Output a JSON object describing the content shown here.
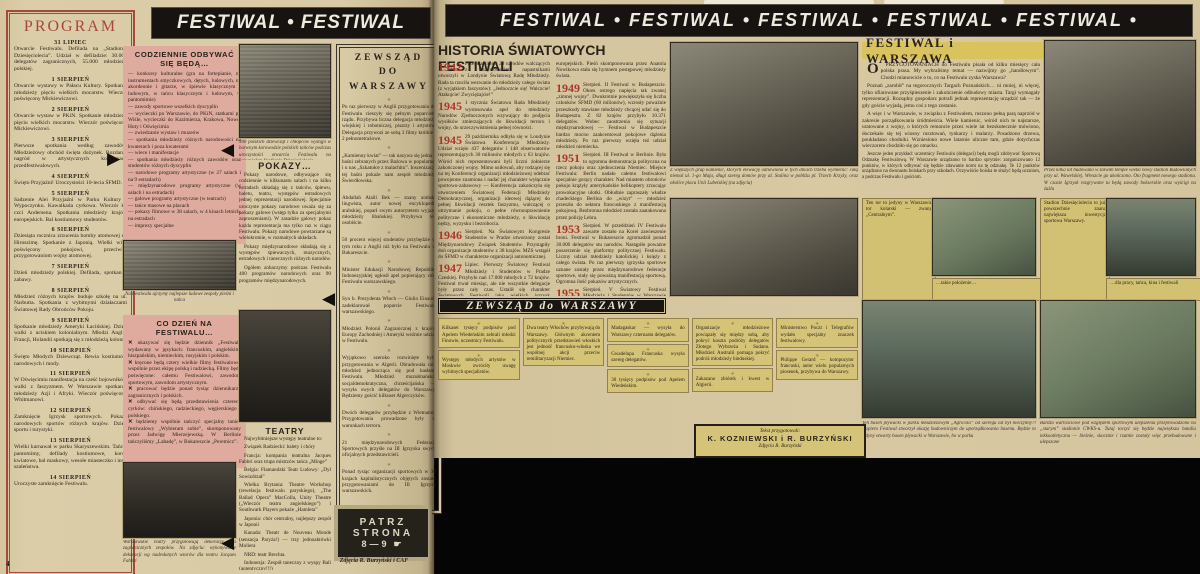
{
  "palette": {
    "newsprint": "#d8caa4",
    "pink_box": "#dfab9e",
    "yellow_box": "#d3c173",
    "accent_red": "#a8473c",
    "banner_black": "#171310",
    "ink": "#2a231b"
  },
  "left_page": {
    "page_number": "4",
    "banner": "FESTIWAL • FESTIWAL",
    "program": {
      "title": "PROGRAM",
      "entries": [
        {
          "date": "31 LIPIEC",
          "text": "Otwarcie Festiwalu. Defilada na „Stadionie Dziesięciolecia”. Udział w defiladzie: 30.000 delegatów zagranicznych, 55.000 młodzieży polskiej."
        },
        {
          "date": "1 SIERPIEŃ",
          "text": "Otwarcie wystawy w Pałacu Kultury. Spotkanie młodzieży pięciu wielkich mocarstw. Wieczór poświęcony Mickiewiczowi."
        },
        {
          "date": "2 SIERPIEŃ",
          "text": "Otwarcie wystaw w PKiN. Spotkanie młodzieży pięciu wielkich mocarstw. Wieczór poświęcony Mickiewiczowi."
        },
        {
          "date": "3 SIERPIEŃ",
          "text": "Pierwsze spotkania według zawodów. Młodzieżowy obchód święta dożynek. Rozdanie nagród w artystycznych konkursach przedfestiwalowych."
        },
        {
          "date": "4 SIERPIEŃ",
          "text": "Święto Przyjaźni! Uroczystości 10-lecia ŚFMD."
        },
        {
          "date": "5 SIERPIEŃ",
          "text": "Sadzenie Alei Przyjaźni w Parku Kultury i Wypoczynku. Kawalkada cyrkowa. Wieczór ku czci Andersena. Spotkania młodzieży krajów europejskich. Bal kostiumowy studentów."
        },
        {
          "date": "6 SIERPIEŃ",
          "text": "Dziesiąta rocznica zrzucenia bomby atomowej na Hiroszimę. Spotkanie z Japonią. Wielki wiec poświęcony pokojowi, przeciwko przygotowaniom wojny atomowej."
        },
        {
          "date": "7 SIERPIEŃ",
          "text": "Dzień młodzieży polskiej. Defilada, spotkania, zabawy."
        },
        {
          "date": "8 SIERPIEŃ",
          "text": "Młodzież różnych krajów buduje szkołę na ul. Narbutta. Spotkania z wybitnymi działaczami Światowej Rady Obrońców Pokoju."
        },
        {
          "date": "9 SIERPIEŃ",
          "text": "Spotkanie młodzieży Ameryki Łacińskiej. Dzień walki z uciskiem kolonialnym. Młodzi Anglii, Francji, Holandii spotkają się z młodzieżą kolonii."
        },
        {
          "date": "10 SIERPIEŃ",
          "text": "Święto Młodych Dziewcząt. Rewia kostiumów narodowych i mody."
        },
        {
          "date": "11 SIERPIEŃ",
          "text": "W Oświęcimiu manifestacja na cześć bojowników walki z faszyzmem. W Warszawie spotkania młodzieży Azji i Afryki. Wieczór poświęcony Whitmanowi."
        },
        {
          "date": "12 SIERPIEŃ",
          "text": "Zamknięcie Igrzysk sportowych. Pokazy narodowych sportów różnych krajów. Dzień sportu i turystyki."
        },
        {
          "date": "13 SIERPIEŃ",
          "text": "Wielki karnawał w parku Skaryszewskim. Tańce, pantomimy, defilady kostiumowe, korso kwiatowe, bal maskowy, wesołe miasteczko i inne szaleństwa."
        },
        {
          "date": "14 SIERPIEŃ",
          "text": "Uroczyste zamknięcie Festiwalu."
        }
      ]
    },
    "daily": {
      "title": "CODZIENNIE ODBYWAĆ SIĘ BĘDĄ…",
      "items": [
        "— konkursy kulturalne (gra na fortepianie, na instrumentach smyczkowych, dętych, ludowych, na akordeonie i gitarze, w śpiewie klasycznym i ludowym, w tańcu klasycznym i ludowym, w pantomimie)",
        "— zawody sportowe wszelkich dyscyplin",
        "— wycieczki po Warszawie, do PKiN, statkami po Wiśle, wycieczki do Kazimierza, Krakowa, Nowej Huty i Oświęcimia",
        "— zwiedzanie wystaw i muzeów",
        "— spotkania młodzieży różnych narodowości na kwaterach i poza kwaterami",
        "— wiece i manifestacje",
        "— spotkania młodzieży różnych zawodów oraz studentów różnych dyscyplin",
        "— narodowe programy artystyczne (w 27 salach i na 9 estradach)",
        "— międzynarodowe programy artystyczne (w salach i na estradach)",
        "— galowe programy artystyczne (w teatrach)",
        "— tańce masowe na placach",
        "— pokazy filmowe w 38 salach, w 4 kinach letnich, na estradach",
        "— imprezy specjalne"
      ]
    },
    "parade_caption": "Na Festiwalu ujrzymy najlepsze ludowe zespoły pieśni i tańca",
    "pokazy": {
      "caption_above": "500 polskich dziewcząt i chłopców wystąpi w barwnym korowodzie polskich tańców podczas uroczystości otwarcia Festiwalu na wspaniałym Stadionie Dziesięciolecia",
      "title": "POKAZY…",
      "paragraphs": [
        "Pokazy narodowe, odbywające się codziennie w kilkunastu salach i na kilku estradach składają się z tańców, śpiewu, baletu, teatru, występów estradowych jednej reprezentacji narodowej. Specjalnie uroczyste pokazy narodowe uważa się za pokazy galowe (wstęp tylko za specjalnymi zaproszeniami). W zasadzie galowy pokaz każda reprezentacja ma tylko raz w ciągu Festiwalu. Pokazy narodowe powtarzane są wielokrotnie, w rozmaitych układach.",
        "Pokazy międzynarodowe składają się z występów śpiewaczych, muzycznych, estradowych i tanecznych różnych narodów.",
        "Ogółem zobaczymy podczas Festiwalu 400 programów narodowych oraz 90 programów międzynarodowych."
      ]
    },
    "codzien": {
      "title": "CO DZIEŃ NA FESTIWALU…",
      "items": [
        "ukazywać się będzie dziennik „Festiwal” wydawany w językach: francuskim, angielskim, hiszpańskim, niemieckim, rosyjskim i polskim.",
        "kręcone będą cztery wielkie filmy festiwalowe, wspólnie przez ekipę polską i radziecką. Filmy będą poświęcone: całemu Festiwalowi, zawodom sportowym, zawodom artystycznym.",
        "pracować będzie ponad tysiąc dziennikarzy zagranicznych i polskich.",
        "odbywać się będą przedstawienia czterech cyrków: chińskiego, radzieckiego, węgierskiego i polskiego.",
        "będziemy wspólnie tańczyć specjalny taniec festiwalowy „Wybieram sobie”, skomponowany przez Jadwigę Mierzejewską. W Berlinie tańczyliśmy „Labadę”, w Bukareszcie „Peremicz”."
      ]
    },
    "decor_caption": "Warszawskie teatry przygotowują dekoracje dla zagranicznych zespołów. Na zdjęciu: wykonywanie dekoracji wg nadesłanych wzorów dla teatru Jacques Fabbri",
    "teatry": {
      "title": "TEATRY",
      "intro": "Najwybitniejsze występy teatralne to:",
      "items": [
        "Związek Radziecki: balety i chóry",
        "Francja: kompania teatralna Jacques Fabbri oraz trupa mistrzów tańca „Minge”",
        "Belgia: Flamandzki Teatr Ludowy: „Dyl Sowizdrzał”",
        "Wielka Brytania: Theatre Workshop (rewelacja festiwalu paryskiego), „The Ballad Opera” MacColla, Unity Theatre („Wieczór teatru angielskiego”) i Southwark Players pokaże „Hamleta”",
        "Japonia: chór centralny, najlepszy zespół w Japonii",
        "Kanada: Theatr de Nouveau Monde (sensacja Paryża!) — trzy jednoaktówki Moliera",
        "NRD: teatr Brechta.",
        "Indonezja: Zespół taneczny z wyspy Bali (autentyczny!!!)"
      ]
    },
    "zewszad": {
      "title_lines": [
        "ZEWSZĄD",
        "DO",
        "WARSZAWY"
      ],
      "items": [
        "Po raz pierwszy w Anglii przygotowania do Festiwalu cieszyły się pełnym poparciem rządu. Przybywa liczna delegacja młodzieży wiejskiej i robotniczej, pisarzy i artystów. Delegacja przywozi ze sobą 3 filmy krótkie i 2 pełnometrażowe.",
        "„Kamienny kwiat” — tak nazywa się jedna z baśni zebranych przez Bażowa w popularnej i u nas „Szkatułce z malachitu”. Inscenizację tej baśni pokaże nam zespół młodzieży Świerdłowska.",
        "Abdallah Alaili Bek — znany arabski lingwista, autor nowej encyklopedii arabskiej, poparł swym autorytetem wyjazd młodzieży libańskiej. Przybywa też osobiście.",
        "50 procent więcej studentów przybędzie w tym roku z Anglii niż było na Festiwalu w Bukareszcie.",
        "Minister Edukacji Narodowej Republiki Indonezyjskiej ogłosił apel popierający cele Festiwalu warszawskiego.",
        "Syn b. Prezydenta Włoch — Giulio Einaudi zadeklarował poparcie Festiwalu warszawskiego.",
        "Młodzież Polonii Zagranicznej z krajów Europy Zachodniej i Ameryki weźmie udział w Festiwalu.",
        "Wyjątkowo szeroko rozwinięte były przygotowania w Algerii. Obradowała cała młodzież jednocząca się pod hasłami Festiwalu. Młodzież muzułmańska, socjaldemokratyczna, chrześcijańska — wysyła swych delegatów do Warszawy. Będziemy gościć kilkuset Algerczyków.",
        "Dwóch delegatów przybędzie z Wietnamu. Przygotowania prowadzone były w warunkach terroru.",
        "21 międzynarodowych Federacji Sportowych przyśle na III Igrzyska swych oficjalnych przedstawicieli.",
        "Ponad tysiąc organizacji sportowych w 30 krajach kapitalistycznych objętych zostało przygotowaniami do III Igrzysk warszawskich."
      ]
    },
    "patrz": {
      "l1": "PATRZ",
      "l2": "STRONA",
      "l3": "8—9",
      "hand": "☛"
    },
    "credit": "Zdjęcia R. Burzyński i CAF"
  },
  "right_page": {
    "banner": "FESTIWAL • FESTIWAL • FESTIWAL • FESTIWAL • FESTIWAL •",
    "history": {
      "title": "HISTORIA ŚWIATOWYCH FESTIWALI",
      "col1": [
        {
          "year": "1942",
          "text": "Przedstawiciele 29 narodów walczących z faszystowskimi napastnikami utworzyli w Londynie Światową Radę Młodzieży. Rada ta rzuciła wezwanie do młodzieży całego świata (z wyjątkiem faszystów): „Jednoczcie się! Walczcie! Atakujcie! Zwyciężajcie!”"
        },
        {
          "year": "1945",
          "text": "1 stycznia Światowa Rada Młodzieży wystosowała apel do młodzieży Narodów Zjednoczonych wzywający do podjęcia wysiłków zmierzających do likwidacji terroru i wojny, do urzeczywistnienia pełnej równości."
        },
        {
          "year": "1945",
          "text": "29 października odbyła się w Londynie Światowa Konferencja Młodzieży. Udział wzięło 437 delegatów i 148 obserwatorów reprezentujących 30 milionów młodych z 63 krajów. Wśród nich reprezentowani byli liczni żołnierze zakończonej wojny. Mimo usiłowań, aby rodzącej się na tej Konferencji organizacji młodzieżowej odebrać powojenne znamiona i nadać jej charakter wyłącznie sportowo-zabawowy — Konferencja zakończyła się utworzeniem Światowej Federacji Młodzieży Demokratycznej, organizacji ideowej dążącej do pełnej likwidacji resztek faszyzmu, walczącej o utrzymanie pokoju, o pełne równouprawnienie polityczne i ekonomiczne młodzieży, o likwidację nędzy, wyzysku i bezrobocia."
        },
        {
          "year": "1946",
          "text": "Sierpień. Na Światowym Kongresie Studentów w Pradze utworzony został Międzynarodowy Związek Studentów. Przystąpiły doń organizacje studentów z 38 krajów. MZS wstąpił do ŚFMD w charakterze organizacji autonomicznej."
        },
        {
          "year": "1947",
          "text": "Lipiec. Pierwszy Światowy Festiwal Młodzieży i Studentów w Pradze Czeskiej. Przybyło nań 17.000 młodych z 72 krajów. Festiwal trwał miesiąc, ale nie wszystkie delegacje były przez cały czas. Ustalił się charakter Światowych Festiwali jako wielkich igrzysk kulturalnych oraz spotkań międzynarodowych. Młodzież wzięła udział w pracach nad odbudową Lidic. Lidice były punktem, do którego dotarły sztafety z wszystkich krajów"
        }
      ],
      "col2_intro": "europejskich. Pieśń skomponowana przez Anatola Nowikowa stała się hymnem postępowej młodzieży świata.",
      "col2": [
        {
          "year": "1949",
          "text": "Sierpień. II Festiwal w Budapeszcie. Okres ostrego napięcia tak zwanej „zimnej wojny”. Dwukrotnie powiększyła się liczba członków ŚFMD (60 milionów), wzrosły poważnie przeszkody stawiane młodzieży chcącej udać się do Budapesztu. Z 82 krajów przybyło 10.371 delegatów. Wobec zaostrzenia się sytuacji międzynarodowej — Festiwal w Budapeszcie bardzo mocno zaakcentował pokojowe dążenia młodzieży. Po raz pierwszy wzięła też udział młodzież niemiecka."
        },
        {
          "year": "1951",
          "text": "Sierpień. III Festiwal w Berlinie. Była to ogromna demonstracja polityczna na rzecz pokoju oraz zjednoczenia Niemiec. Miejsce Festiwalu: Berlin nadało całemu festiwalowi specjalnie gorący charakter. Nad miastem obrońców pokoju krążyły amerykańskie helikoptery zrzucając prowokacyjne ulotki. Obłudnie zapraszały władze chadeckiego Berlina do „wizyt” — młodzież przeszła do sektora francuskiego z manifestacją pokojową. Bezbronna młodzież została zaatakowana przez policję Lehra."
        },
        {
          "year": "1953",
          "text": "Sierpień. W przeddzień IV Festiwalu zawarte zostało na Korei zawieszenie broni. Festiwal w Bukareszcie zgromadził ponad 30.000 delegatów stu narodów. Nastąpiło poważne poszerzenie się platformy politycznej Festiwalu. Liczny udział młodzieży katolickiej i księży z całego świata. Po raz pierwszy igrzyska sportowe uznane zostały przez międzynarodowe federacje sportowe, stały się poważną manifestacją sportową. Ogromna ilość pokazów artystycznych."
        },
        {
          "year": "1955",
          "text": "Sierpień. V Światowy Festiwal Młodzieży i Studentów w Warszawie — w mieście będącym światowym symbolem pokojowego budownictwa."
        }
      ]
    },
    "fiw": {
      "title": "FESTIWAL i WARSZAWA",
      "dropcap": "O",
      "lead": "PRZYGOTOWANIACH do Festiwalu pisała od kilku miesięcy cała polska prasa. My wybraliśmy temat — nazwijmy go „handlowym”. Chodzi mianowicie o to, co na Festiwalu zyska Warszawa?",
      "paragraphs": [
        "Poznań „zarobił” na tegorocznych Targach Poznańskich… ni mniej, ni więcej, tylko ofiarowane przyśpieszenie i zakończenie odbudowy miasta. Targi wymagały reprezentacji. Rozsądny gospodarz potrafi jednak reprezentację urządzić tak — że gdy goście wyjadą, jemu coś z tego zostanie.",
        "A więc i w Warszawie, w związku z Festiwalem, ruszono pełną parą naprzód w zakresie porządkowania śródmieścia. Wiele kamienic, wśród nich te najstarsze, uratowane z wojny, o których remoncie przez wiele lat bezskutecznie mówiono, doczekało się tej wiosny rusztowań, tynkarzy i malarzy. Posadzono drzewa, poukładano chodniki. Wzniesiono nowe latarnie uliczne tam, gdzie dotychczas wieczorem chodziło się po omacku."
      ],
      "small": "Jeszcze jeden przykład: uczestnicy Festiwalu (delegaci) będą mogli zdobywać Sportową Odznakę Festiwalową. W Warszawie urządzono to bardzo sprytnie: zorganizowano 12 punktów, w których odbywać się będzie zdawanie norm na tę odznakę. Te 12 punktów urządzono na dwunastu boiskach przy szkołach. Oczywiście boiska te służyć będą uczniom, a podczas Festiwalu i gościom."
    },
    "captions": {
      "building": "Z większych grup kamienic, których elewację odnowiono w tych dniach trzeba wymienić: całą niemal ul. 1-go Maja, długi szereg domów przy al. Stalina w pobliżu pl. Trzech Krzyży, oraz okolice placu Unii Lubelskiej (na zdjęciu)",
      "tower": "Przez kilka lat budowano w żółwim tempie wielki nowy stadion Budowlanych przy ul. Wawelskiej. Wreszcie go ukończono. Oto fragment nowego stadionu. W czasie Igrzysk rozgrywane tu będą zawody bokserskie oraz wyścigi na żużlu",
      "velodrome": "Ten tor to jedyny w Warszawie tor kolarski — zwany „Centralnym”.",
      "green_strip": "…takie położenie…",
      "stadium_note": "Stadion Dziesięciolecia to już powszechnie znana największa inwestycja sportowa Warszawy.",
      "boat_strip": "…dla pracy, tańca, kina i festiwali",
      "pool": "Ten basen pływacki w parku młodzieżowym „Agricola” od szeregu lat był nieczynny?! Dopiero Festiwal stworzył okazję budowniczym do uporządkowania basenu. Będzie to jedyny otwarty basen pływacki w Warszawie, bo w parku",
      "workers": "Bardzo wartościowe pod względem sportowym ulepszenia przeprowadzono na „starym” stadionie CWKS-u. Tutaj toczyć się będzie największa batalia lekkoatletyczna — bieżnie, skocznie i rzutnie zostały więc przebudowane i ulepszone"
    },
    "zewszad2": {
      "title": "ZEWSZĄD do WARSZAWY",
      "col1": [
        "Kilkaset tysięcy podpisów pod Apelem Wiedeńskim zebrali młodzi Finowie, uczestnicy Festiwalu.",
        "Występy młodych artystów w Moskwie zwróciły uwagę wybitnych specjalistów."
      ],
      "col2": [
        "Dwa teatry Włochów przybywają do Warszawy. Głównym akcentem politycznych przedstawień włoskich jest jedność francusko-włoska we wspólnej akcji przeciw remilitaryzacji Niemiec."
      ],
      "col3": [
        "Madagaskar — wysyła do Warszawy czternastu delegatów.",
        "Gwadelupa Francuska wysyła szereg delegatów.",
        "30 tysięcy podpisów pod Apelem Wiedeńskim."
      ],
      "col4": [
        "Organizacje młodzieżowe powiązały się między sobą, aby pokryć koszta podróży delegatów Złotego Wybrzeża i Sudanu. Młodzież Australii pomaga pokryć podróż młodzieży hinduskiej.",
        "Zakazano zbiórek i kwest w Algierii."
      ],
      "col5": [
        "Ministerstwo Poczt i Telegrafów wydało specjalny znaczek festiwalowy.",
        "Philippe Gerard — kompozytor francuski, autor wielu popularnych piosenek, przybywa do Warszawy."
      ]
    },
    "credit_box": {
      "l1": "Tekst przygotowali:",
      "l2": "K. KOZNIEWSKI i R. BURZYŃSKI",
      "l3": "Zdjęcia R. Burzyński"
    }
  }
}
